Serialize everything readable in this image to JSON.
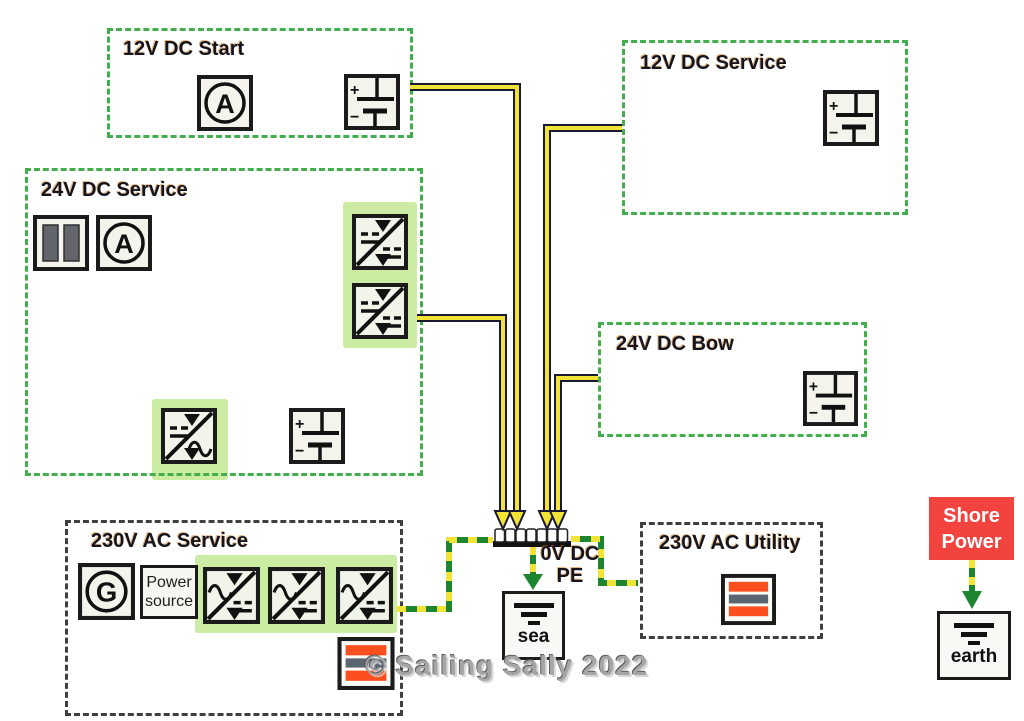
{
  "groups": [
    {
      "label": "12V DC Start"
    },
    {
      "label": "12V DC Service"
    },
    {
      "label": "24V DC Service"
    },
    {
      "label": "24V DC Bow"
    },
    {
      "label": "230V AC Service"
    },
    {
      "label": "230V AC Utility"
    }
  ],
  "bus_label": {
    "line1": "0V DC",
    "line2": "PE"
  },
  "shore_power": {
    "line1": "Shore",
    "line2": "Power"
  },
  "sea_label": "sea",
  "earth_label": "earth",
  "power_source": {
    "line1": "Power",
    "line2": "source"
  },
  "watermark": "© Sailing Sally 2022",
  "glyphs": {
    "ammeter": "A",
    "generator": "G",
    "plus": "+",
    "minus": "−"
  },
  "icons": {
    "ammeter": "circle-A-meter",
    "generator": "circle-G-generator",
    "battery": "battery-cell-plus-minus",
    "battery_bank": "double-gray-bar-shunt",
    "dc_dc_converter": "square-diagonal-dc-to-dc-arrows",
    "inverter": "square-diagonal-dc-to-ac-arrows",
    "charger": "square-diagonal-ac-to-dc-arrows",
    "load": "orange-gray-striped-load",
    "busbar": "pe-terminal-strip",
    "ground": "earth-ground-bars"
  },
  "colors": {
    "dc_box_border": "#43ae4d",
    "ac_box_border": "#3f3f3f",
    "highlight_green": "#cdeca3",
    "wire_yellow": "#f2e437",
    "wire_outline": "#191930",
    "earth_green": "#1d8430",
    "icon_bg": "#f4f4ec",
    "stripe_orange": "#fd4f1d",
    "stripe_gray": "#5a6570",
    "shore_red": "#f3433f",
    "title_text": "#15151f",
    "watermark_gray": "#a6a6a6"
  }
}
